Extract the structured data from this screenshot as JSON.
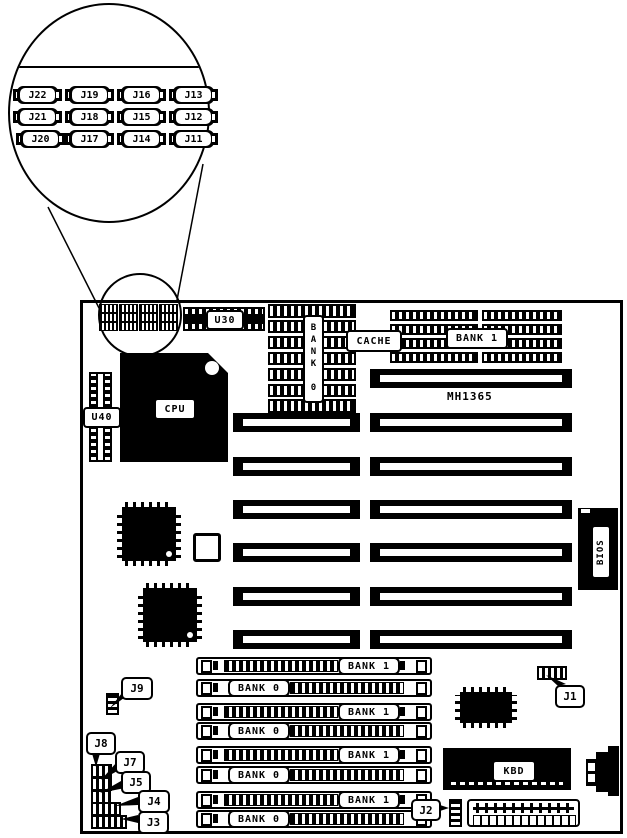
{
  "diagram": {
    "magnifier": {
      "jumpers": [
        "J22",
        "J19",
        "J16",
        "J13",
        "J21",
        "J18",
        "J15",
        "J12",
        "J20",
        "J17",
        "J14",
        "J11"
      ]
    },
    "board": {
      "model": "MH1365",
      "u30": "U30",
      "u40": "U40",
      "cpu": "CPU",
      "bios": "BIOS",
      "kbd": "KBD",
      "cache": "CACHE",
      "cache_bank": "BANK 0",
      "dram_bank": "BANK 1",
      "simm": [
        "BANK 1",
        "BANK 0",
        "BANK 1",
        "BANK 0",
        "BANK 1",
        "BANK 0",
        "BANK 1",
        "BANK 0"
      ],
      "callouts": {
        "j1": "J1",
        "j2": "J2",
        "j3": "J3",
        "j4": "J4",
        "j5": "J5",
        "j7": "J7",
        "j8": "J8",
        "j9": "J9"
      }
    },
    "colors": {
      "ink": "#000000",
      "paper": "#ffffff"
    }
  }
}
